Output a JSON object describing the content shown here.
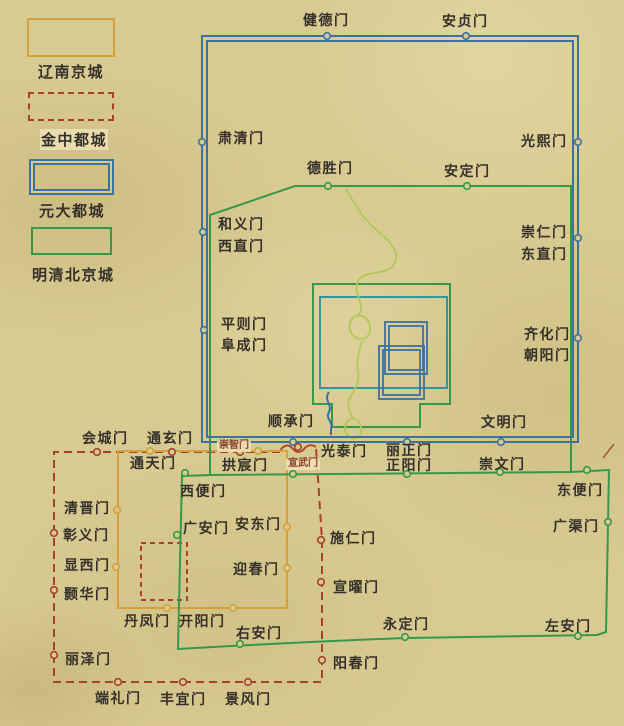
{
  "legend": {
    "items": [
      {
        "id": "liao",
        "label": "辽南京城",
        "color": "#d6a13d",
        "line_style": "solid"
      },
      {
        "id": "jin",
        "label": "金中都城",
        "color": "#a7402c",
        "line_style": "dashed"
      },
      {
        "id": "yuan",
        "label": "元大都城",
        "color": "#3d719f",
        "line_style": "double"
      },
      {
        "id": "ming-qing",
        "label": "明清北京城",
        "color": "#36984a",
        "line_style": "solid"
      }
    ]
  },
  "map": {
    "colors": {
      "parchment": "#d8cb92",
      "liao_wall": "#d6a13d",
      "jin_wall": "#a7402c",
      "yuan_wall": "#3d719f",
      "ming_wall": "#36984a",
      "imperial_city": "#2f96a2",
      "water": "#b0c859",
      "label_text": "#35302a",
      "small_label_text": "#8b4434"
    },
    "labels": [
      {
        "id": "jiande-men",
        "text": "健德门",
        "x": 303,
        "y": 13,
        "group": "yuan",
        "variant": "normal"
      },
      {
        "id": "anzhen-men",
        "text": "安贞门",
        "x": 442,
        "y": 14,
        "group": "yuan",
        "variant": "normal"
      },
      {
        "id": "suqing-men",
        "text": "肃清门",
        "x": 218,
        "y": 131,
        "group": "yuan",
        "variant": "normal"
      },
      {
        "id": "guangxi-men",
        "text": "光熙门",
        "x": 521,
        "y": 134,
        "group": "yuan",
        "variant": "normal"
      },
      {
        "id": "heyi-men",
        "text": "和义门",
        "x": 218,
        "y": 217,
        "group": "yuan",
        "variant": "normal"
      },
      {
        "id": "xizhi-men",
        "text": "西直门",
        "x": 218,
        "y": 239,
        "group": "ming-inner",
        "variant": "normal"
      },
      {
        "id": "chongren-men",
        "text": "崇仁门",
        "x": 521,
        "y": 225,
        "group": "yuan",
        "variant": "normal"
      },
      {
        "id": "dongzhi-men",
        "text": "东直门",
        "x": 521,
        "y": 247,
        "group": "ming-inner",
        "variant": "normal"
      },
      {
        "id": "pingze-men",
        "text": "平则门",
        "x": 221,
        "y": 317,
        "group": "yuan",
        "variant": "normal"
      },
      {
        "id": "fucheng-men",
        "text": "阜成门",
        "x": 221,
        "y": 338,
        "group": "ming-inner",
        "variant": "normal"
      },
      {
        "id": "qihua-men",
        "text": "齐化门",
        "x": 524,
        "y": 327,
        "group": "yuan",
        "variant": "normal"
      },
      {
        "id": "chaoyang-men",
        "text": "朝阳门",
        "x": 524,
        "y": 348,
        "group": "ming-inner",
        "variant": "normal"
      },
      {
        "id": "shuncheng-men",
        "text": "顺承门",
        "x": 268,
        "y": 414,
        "group": "yuan",
        "variant": "normal"
      },
      {
        "id": "wenming-men",
        "text": "文明门",
        "x": 481,
        "y": 415,
        "group": "yuan",
        "variant": "normal"
      },
      {
        "id": "lizheng-men",
        "text": "丽正门",
        "x": 386,
        "y": 443,
        "group": "yuan",
        "variant": "normal"
      },
      {
        "id": "desheng-men",
        "text": "德胜门",
        "x": 307,
        "y": 161,
        "group": "ming-inner",
        "variant": "normal"
      },
      {
        "id": "anding-men",
        "text": "安定门",
        "x": 444,
        "y": 164,
        "group": "ming-inner",
        "variant": "normal"
      },
      {
        "id": "zhengyang-men",
        "text": "正阳门",
        "x": 386,
        "y": 458,
        "group": "ming-inner",
        "variant": "normal"
      },
      {
        "id": "chongwen-men",
        "text": "崇文门",
        "x": 479,
        "y": 457,
        "group": "ming-inner",
        "variant": "normal"
      },
      {
        "id": "xuanwu-men",
        "text": "宣武门",
        "x": 286,
        "y": 459,
        "group": "ming-inner",
        "variant": "small"
      },
      {
        "id": "xibian-men",
        "text": "西便门",
        "x": 180,
        "y": 484,
        "group": "ming-outer",
        "variant": "normal"
      },
      {
        "id": "guangan-men",
        "text": "广安门",
        "x": 183,
        "y": 521,
        "group": "ming-outer",
        "variant": "normal"
      },
      {
        "id": "youan-men",
        "text": "右安门",
        "x": 236,
        "y": 626,
        "group": "ming-outer",
        "variant": "normal"
      },
      {
        "id": "yongding-men",
        "text": "永定门",
        "x": 383,
        "y": 617,
        "group": "ming-outer",
        "variant": "normal"
      },
      {
        "id": "zuoan-men",
        "text": "左安门",
        "x": 545,
        "y": 619,
        "group": "ming-outer",
        "variant": "normal"
      },
      {
        "id": "guangqu-men",
        "text": "广渠门",
        "x": 553,
        "y": 519,
        "group": "ming-outer",
        "variant": "normal"
      },
      {
        "id": "dongbian-men",
        "text": "东便门",
        "x": 557,
        "y": 483,
        "group": "ming-outer",
        "variant": "normal"
      },
      {
        "id": "tongtian-men",
        "text": "通天门",
        "x": 130,
        "y": 456,
        "group": "liao",
        "variant": "normal"
      },
      {
        "id": "gongchen-men",
        "text": "拱宸门",
        "x": 222,
        "y": 458,
        "group": "liao",
        "variant": "normal"
      },
      {
        "id": "qingjin-men",
        "text": "清晋门",
        "x": 64,
        "y": 501,
        "group": "liao",
        "variant": "normal"
      },
      {
        "id": "xianxi-men",
        "text": "显西门",
        "x": 64,
        "y": 558,
        "group": "liao",
        "variant": "normal"
      },
      {
        "id": "andong-men",
        "text": "安东门",
        "x": 235,
        "y": 517,
        "group": "liao",
        "variant": "normal"
      },
      {
        "id": "yingchun-men",
        "text": "迎春门",
        "x": 233,
        "y": 562,
        "group": "liao",
        "variant": "normal"
      },
      {
        "id": "danfeng-men",
        "text": "丹凤门",
        "x": 124,
        "y": 614,
        "group": "liao",
        "variant": "normal"
      },
      {
        "id": "kaiyang-men",
        "text": "开阳门",
        "x": 179,
        "y": 614,
        "group": "liao",
        "variant": "normal"
      },
      {
        "id": "huicheng-men",
        "text": "会城门",
        "x": 82,
        "y": 431,
        "group": "jin",
        "variant": "normal"
      },
      {
        "id": "tongxuan-men",
        "text": "通玄门",
        "x": 147,
        "y": 431,
        "group": "jin",
        "variant": "normal"
      },
      {
        "id": "chongzhi-men",
        "text": "崇智门",
        "x": 217,
        "y": 441,
        "group": "jin",
        "variant": "small"
      },
      {
        "id": "guangtai-men",
        "text": "光泰门",
        "x": 321,
        "y": 444,
        "group": "jin",
        "variant": "normal"
      },
      {
        "id": "shiren-men",
        "text": "施仁门",
        "x": 330,
        "y": 531,
        "group": "jin",
        "variant": "normal"
      },
      {
        "id": "xuanyao-men",
        "text": "宣曜门",
        "x": 333,
        "y": 580,
        "group": "jin",
        "variant": "normal"
      },
      {
        "id": "yangchun-men",
        "text": "阳春门",
        "x": 333,
        "y": 656,
        "group": "jin",
        "variant": "normal"
      },
      {
        "id": "zhangyi-men",
        "text": "彰义门",
        "x": 63,
        "y": 528,
        "group": "jin",
        "variant": "normal"
      },
      {
        "id": "haohua-men",
        "text": "颢华门",
        "x": 64,
        "y": 587,
        "group": "jin",
        "variant": "normal"
      },
      {
        "id": "lize-men",
        "text": "丽泽门",
        "x": 65,
        "y": 652,
        "group": "jin",
        "variant": "normal"
      },
      {
        "id": "duanli-men",
        "text": "端礼门",
        "x": 95,
        "y": 691,
        "group": "jin",
        "variant": "normal"
      },
      {
        "id": "fengyi-men",
        "text": "丰宜门",
        "x": 160,
        "y": 692,
        "group": "jin",
        "variant": "normal"
      },
      {
        "id": "jingfeng-men",
        "text": "景风门",
        "x": 225,
        "y": 692,
        "group": "jin",
        "variant": "normal"
      }
    ]
  }
}
